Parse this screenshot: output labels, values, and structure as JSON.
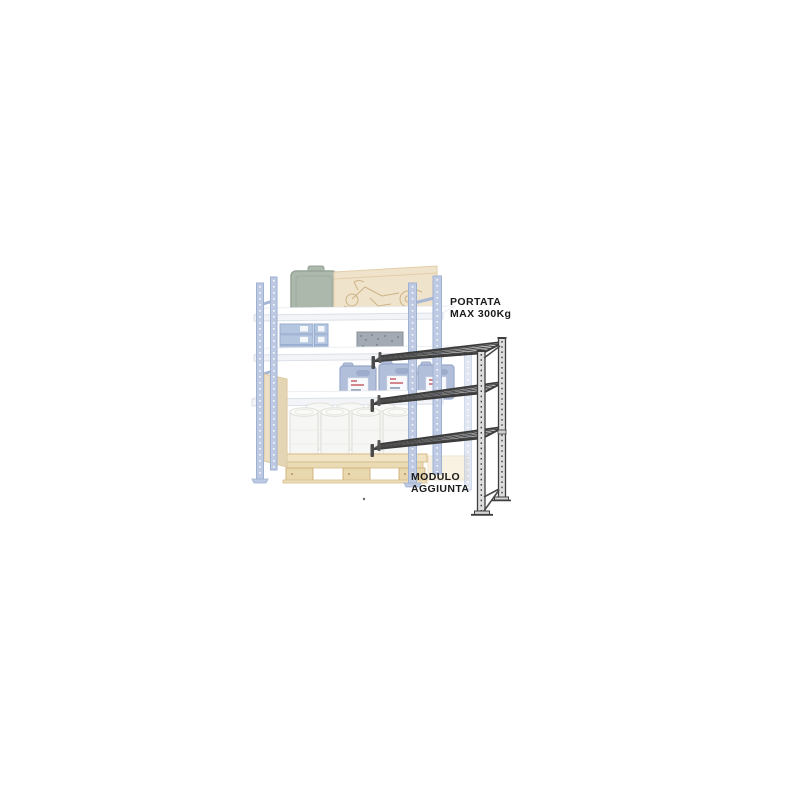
{
  "page": {
    "background": "#ffffff"
  },
  "illustration": {
    "type": "shelving add-on module product diagram",
    "labels": {
      "capacity": {
        "line1": "PORTATA",
        "line2": "MAX 300Kg"
      },
      "module": {
        "line1": "MODULO",
        "line2": "AGGIUNTA"
      }
    },
    "colors": {
      "label_text": "#1b1b1b",
      "module_frame_stroke": "#3d3d3d",
      "module_frame_fill": "#dedede",
      "existing_upright_blue": "#b7c5e0",
      "existing_upright_stroke": "#95a9cd",
      "shelf_white": "#fbfcfe",
      "pallet_wood": "#eedfbc",
      "jerrycan_blue": "#aab9d8",
      "case_green": "#a5b1a4",
      "cardboard_tan": "#efe0c6",
      "drum_white": "#f6f6f3"
    },
    "parts": {
      "faded_existing_rack": "existing loaded shelving bay (faded)",
      "dark_addon_module": "add-on module frame with 3 shelves"
    }
  }
}
